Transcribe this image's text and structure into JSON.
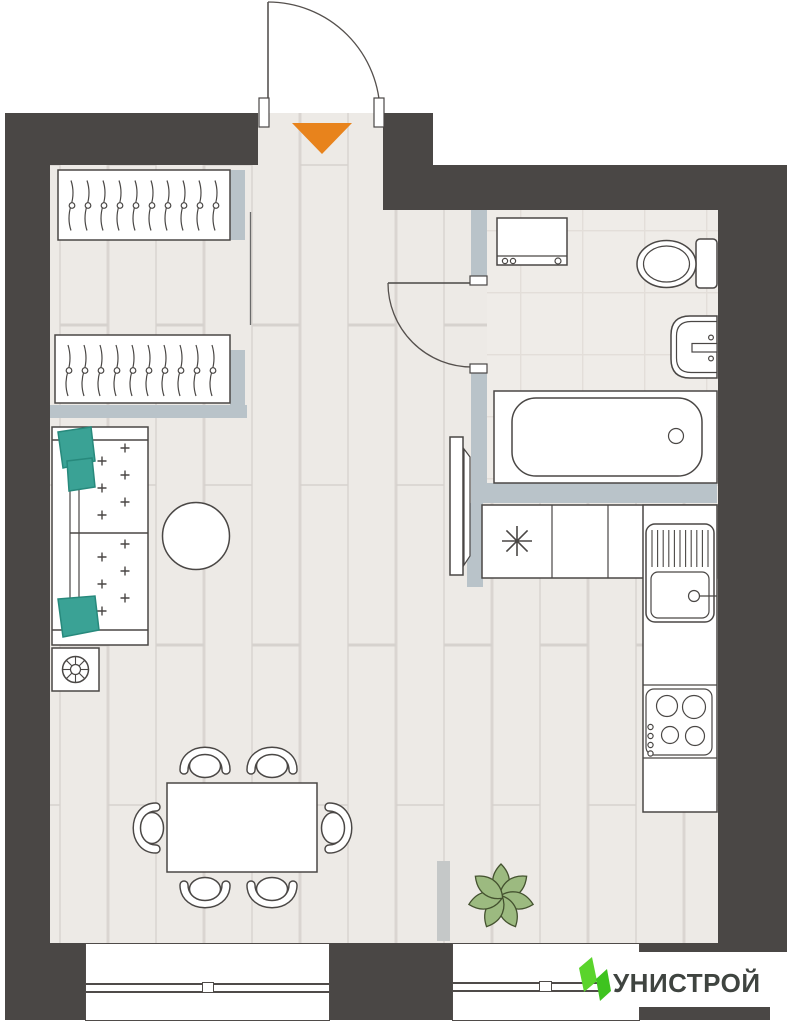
{
  "branding": {
    "logo_text": "УНИСТРОЙ",
    "logo_green_light": "#5ad42c",
    "logo_green_dark": "#3ec31f",
    "logo_text_color": "#3f4440"
  },
  "palette": {
    "wall": "#4a4745",
    "partition": "#b9c3c9",
    "floor": "#edeae6",
    "floor_line": "#dad5d1",
    "bathroom_tile": "#efece8",
    "tile_line": "#e3ded9",
    "outline": "#4a4745",
    "pillow_teal": "#3aa295",
    "plant_green": "#9cba80",
    "entrance_arrow": "#e8831c"
  },
  "entrance": {
    "marker": "down-arrow",
    "marker_color": "#e8831c"
  },
  "furniture": {
    "wardrobe_count": 2,
    "hangers_per_wardrobe": 10,
    "sofa_seats": 2,
    "sofa_pillows": 3,
    "dining_chairs": 6,
    "stove_burners": 4,
    "symbols": [
      "entry-door-swing",
      "wardrobe",
      "wardrobe",
      "sofa",
      "side-table",
      "coffee-table",
      "dining-table",
      "chair",
      "refrigerator",
      "kitchen-sink",
      "cooktop",
      "open-door-leaf",
      "bathroom-door-swing",
      "washing-machine",
      "toilet",
      "wash-basin",
      "bathtub",
      "plant"
    ]
  }
}
